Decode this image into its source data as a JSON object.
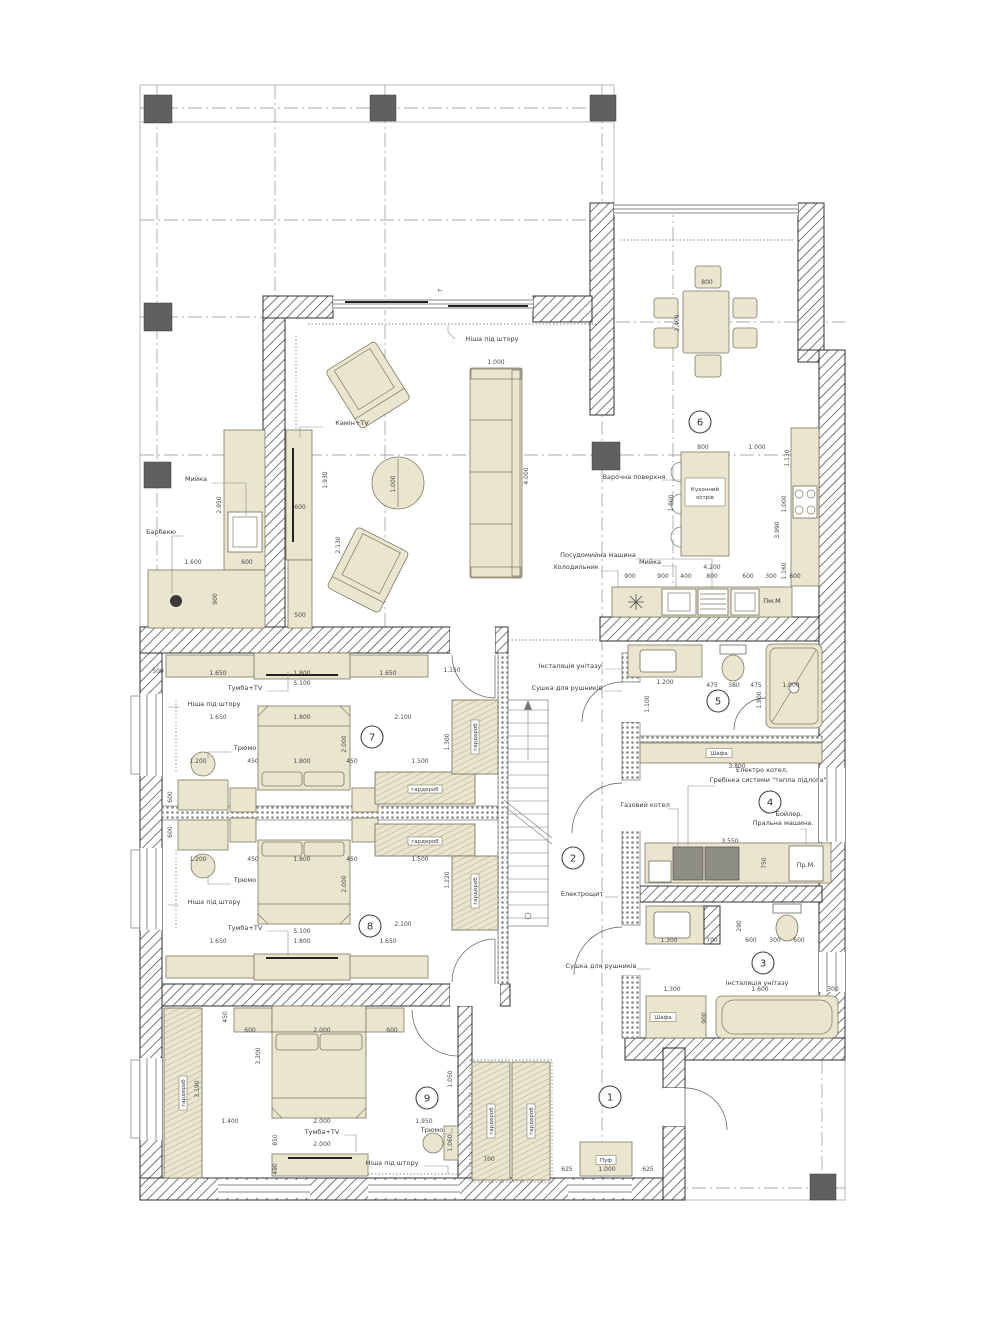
{
  "colors": {
    "furniture_fill": "#eae5ce",
    "wall_line": "#2f2f2f",
    "column_fill": "#606060",
    "dim_text": "#4a4a4a",
    "grid_line": "#8f8f8f"
  },
  "plan": {
    "room_numbers": [
      {
        "n": "1",
        "x": 610,
        "y": 1097
      },
      {
        "n": "2",
        "x": 573,
        "y": 858
      },
      {
        "n": "3",
        "x": 763,
        "y": 963
      },
      {
        "n": "4",
        "x": 770,
        "y": 802
      },
      {
        "n": "5",
        "x": 718,
        "y": 701
      },
      {
        "n": "6",
        "x": 700,
        "y": 422
      },
      {
        "n": "7",
        "x": 372,
        "y": 737
      },
      {
        "n": "8",
        "x": 370,
        "y": 926
      },
      {
        "n": "9",
        "x": 427,
        "y": 1098
      }
    ],
    "furniture_labels": [
      {
        "t": "Ніша під штору",
        "x": 492,
        "y": 341,
        "ld": [
          [
            455,
            339
          ],
          [
            448,
            332
          ],
          [
            448,
            325
          ]
        ]
      },
      {
        "t": "Камін+TV",
        "x": 352,
        "y": 425,
        "ld": [
          [
            323,
            427
          ],
          [
            300,
            427
          ],
          [
            300,
            438
          ]
        ]
      },
      {
        "t": "Мийка",
        "x": 196,
        "y": 481,
        "ld": [
          [
            212,
            483
          ],
          [
            246,
            483
          ],
          [
            246,
            516
          ]
        ]
      },
      {
        "t": "Барбекю",
        "x": 161,
        "y": 534,
        "ld": [
          [
            183,
            536
          ],
          [
            172,
            536
          ],
          [
            172,
            594
          ]
        ]
      },
      {
        "t": "Варочна поверхня",
        "x": 634,
        "y": 479,
        "ld": [
          [
            662,
            480
          ],
          [
            682,
            480
          ]
        ]
      },
      {
        "t": "Посудомийна машина",
        "x": 598,
        "y": 557,
        "ld": [
          [
            636,
            559
          ],
          [
            712,
            559
          ],
          [
            712,
            588
          ]
        ]
      },
      {
        "t": "Мийка",
        "x": 650,
        "y": 564,
        "ld": [
          [
            662,
            566
          ],
          [
            676,
            566
          ],
          [
            676,
            588
          ]
        ]
      },
      {
        "t": "Холодильник",
        "x": 576,
        "y": 569,
        "ld": [
          [
            601,
            571
          ],
          [
            618,
            571
          ],
          [
            618,
            588
          ]
        ]
      },
      {
        "t": "Пм.М",
        "x": 772,
        "y": 603
      },
      {
        "t": "Інсталяція унітазу",
        "x": 570,
        "y": 668,
        "ld": [
          [
            605,
            669
          ],
          [
            622,
            669
          ]
        ]
      },
      {
        "t": "Сушка для рушників",
        "x": 567,
        "y": 690,
        "ld": [
          [
            604,
            691
          ],
          [
            622,
            691
          ]
        ]
      },
      {
        "t": "Електро котел,",
        "x": 762,
        "y": 772
      },
      {
        "t": "Гребінка системи \"тепла підлога\"",
        "x": 768,
        "y": 782,
        "ld": [
          [
            716,
            786
          ],
          [
            688,
            786
          ],
          [
            688,
            846
          ]
        ]
      },
      {
        "t": "Газовий котел",
        "x": 645,
        "y": 807,
        "ld": [
          [
            668,
            809
          ],
          [
            678,
            809
          ],
          [
            678,
            846
          ]
        ]
      },
      {
        "t": "Бойлер,",
        "x": 789,
        "y": 816
      },
      {
        "t": "Пральна машина.",
        "x": 783,
        "y": 825,
        "ld": [
          [
            800,
            829
          ],
          [
            806,
            829
          ],
          [
            806,
            845
          ]
        ]
      },
      {
        "t": "Пр.М.",
        "x": 806,
        "y": 867
      },
      {
        "t": "Сушка для рушників",
        "x": 601,
        "y": 968,
        "ld": [
          [
            637,
            969
          ],
          [
            650,
            969
          ]
        ]
      },
      {
        "t": "Інсталяція унітазу",
        "x": 757,
        "y": 985
      },
      {
        "t": "Тумба+TV",
        "x": 245,
        "y": 690,
        "ld": [
          [
            267,
            691
          ],
          [
            288,
            691
          ],
          [
            288,
            672
          ]
        ]
      },
      {
        "t": "Ніша під штору",
        "x": 214,
        "y": 706,
        "ld": [
          [
            179,
            707
          ],
          [
            168,
            707
          ]
        ]
      },
      {
        "t": "Трюмо",
        "x": 245,
        "y": 750,
        "ld": [
          [
            231,
            752
          ],
          [
            208,
            752
          ],
          [
            208,
            758
          ]
        ]
      },
      {
        "t": "Трюмо",
        "x": 245,
        "y": 882,
        "ld": [
          [
            231,
            884
          ],
          [
            208,
            884
          ],
          [
            208,
            876
          ]
        ]
      },
      {
        "t": "Ніша під штору",
        "x": 214,
        "y": 904,
        "ld": [
          [
            179,
            905
          ],
          [
            168,
            905
          ]
        ]
      },
      {
        "t": "Тумба+TV",
        "x": 245,
        "y": 930,
        "ld": [
          [
            267,
            931
          ],
          [
            288,
            931
          ],
          [
            288,
            956
          ]
        ]
      },
      {
        "t": "Електрощит",
        "x": 582,
        "y": 896,
        "ld": [
          [
            605,
            897
          ],
          [
            618,
            897
          ]
        ]
      },
      {
        "t": "Тумба+TV",
        "x": 322,
        "y": 1134,
        "ld": [
          [
            344,
            1135
          ],
          [
            356,
            1135
          ],
          [
            356,
            1152
          ]
        ]
      },
      {
        "t": "Трюмо",
        "x": 432,
        "y": 1132,
        "ld": [
          [
            445,
            1134
          ],
          [
            452,
            1134
          ],
          [
            452,
            1128
          ]
        ]
      },
      {
        "t": "Ніша під штору",
        "x": 392,
        "y": 1165,
        "ld": [
          [
            424,
            1166
          ],
          [
            448,
            1166
          ],
          [
            448,
            1174
          ]
        ]
      }
    ],
    "boxed_labels": [
      {
        "t": "Кухонний",
        "t2": "острів",
        "x": 705,
        "y": 492,
        "w": 40,
        "h": 18
      },
      {
        "t": "Шафа",
        "x": 719,
        "y": 753,
        "w": 26,
        "h": 9
      },
      {
        "t": "Шафа",
        "x": 663,
        "y": 1017,
        "w": 26,
        "h": 9
      },
      {
        "t": "Пуф",
        "x": 606,
        "y": 1160,
        "w": 20,
        "h": 9
      },
      {
        "t": "гардероб",
        "x": 425,
        "y": 789,
        "w": 34,
        "h": 8
      },
      {
        "t": "гардероб",
        "x": 425,
        "y": 841,
        "w": 34,
        "h": 8
      },
      {
        "t": "гардероб",
        "x": 475,
        "y": 737,
        "w": 34,
        "h": 8,
        "r": 1
      },
      {
        "t": "гардероб",
        "x": 475,
        "y": 891,
        "w": 34,
        "h": 8,
        "r": 1
      },
      {
        "t": "гардероб",
        "x": 183,
        "y": 1093,
        "w": 34,
        "h": 8,
        "r": 1
      },
      {
        "t": "гардероб",
        "x": 491,
        "y": 1121,
        "w": 34,
        "h": 8,
        "r": 1
      },
      {
        "t": "гардероб",
        "x": 531,
        "y": 1121,
        "w": 34,
        "h": 8,
        "r": 1
      }
    ],
    "dimension_labels": [
      {
        "t": "←",
        "x": 440,
        "y": 292
      },
      {
        "t": "1.000",
        "x": 496,
        "y": 364
      },
      {
        "t": "4.000",
        "x": 528,
        "y": 476,
        "r": 1
      },
      {
        "t": "1.000",
        "x": 395,
        "y": 484,
        "r": 1
      },
      {
        "t": "2.130",
        "x": 340,
        "y": 545,
        "r": 1
      },
      {
        "t": "1.930",
        "x": 327,
        "y": 480,
        "r": 1
      },
      {
        "t": "600",
        "x": 300,
        "y": 509
      },
      {
        "t": "500",
        "x": 300,
        "y": 617
      },
      {
        "t": "2.950",
        "x": 221,
        "y": 505,
        "r": 1
      },
      {
        "t": "1.600",
        "x": 193,
        "y": 564
      },
      {
        "t": "600",
        "x": 247,
        "y": 564
      },
      {
        "t": "900",
        "x": 217,
        "y": 599,
        "r": 1
      },
      {
        "t": "800",
        "x": 707,
        "y": 284
      },
      {
        "t": "1.400",
        "x": 679,
        "y": 323,
        "r": 1
      },
      {
        "t": "800",
        "x": 703,
        "y": 449
      },
      {
        "t": "1.000",
        "x": 757,
        "y": 449
      },
      {
        "t": "1.800",
        "x": 673,
        "y": 503,
        "r": 1
      },
      {
        "t": "1.130",
        "x": 789,
        "y": 458,
        "r": 1
      },
      {
        "t": "1.000",
        "x": 786,
        "y": 504,
        "r": 1
      },
      {
        "t": "3.990",
        "x": 779,
        "y": 530,
        "r": 1
      },
      {
        "t": "1.160",
        "x": 786,
        "y": 571,
        "r": 1
      },
      {
        "t": "4.200",
        "x": 712,
        "y": 569
      },
      {
        "t": "900",
        "x": 630,
        "y": 578
      },
      {
        "t": "900",
        "x": 663,
        "y": 578
      },
      {
        "t": "400",
        "x": 686,
        "y": 578
      },
      {
        "t": "800",
        "x": 712,
        "y": 578
      },
      {
        "t": "600",
        "x": 748,
        "y": 578
      },
      {
        "t": "300",
        "x": 771,
        "y": 578
      },
      {
        "t": "600",
        "x": 795,
        "y": 578
      },
      {
        "t": "1.200",
        "x": 665,
        "y": 684
      },
      {
        "t": "475",
        "x": 712,
        "y": 687
      },
      {
        "t": "380",
        "x": 734,
        "y": 687
      },
      {
        "t": "475",
        "x": 756,
        "y": 687
      },
      {
        "t": "1.000",
        "x": 791,
        "y": 687
      },
      {
        "t": "1.100",
        "x": 649,
        "y": 704,
        "r": 1
      },
      {
        "t": "1.900",
        "x": 761,
        "y": 700,
        "r": 1
      },
      {
        "t": "3.800",
        "x": 737,
        "y": 768
      },
      {
        "t": "3.550",
        "x": 730,
        "y": 843
      },
      {
        "t": "750",
        "x": 766,
        "y": 863,
        "r": 1
      },
      {
        "t": "1.300",
        "x": 669,
        "y": 942
      },
      {
        "t": "700",
        "x": 712,
        "y": 942
      },
      {
        "t": "600",
        "x": 751,
        "y": 942
      },
      {
        "t": "300",
        "x": 775,
        "y": 942
      },
      {
        "t": "600",
        "x": 799,
        "y": 942
      },
      {
        "t": "290",
        "x": 741,
        "y": 926,
        "r": 1
      },
      {
        "t": "1.300",
        "x": 672,
        "y": 991
      },
      {
        "t": "1.600",
        "x": 760,
        "y": 991
      },
      {
        "t": "300",
        "x": 833,
        "y": 991
      },
      {
        "t": "900",
        "x": 706,
        "y": 1018,
        "r": 1
      },
      {
        "t": "500",
        "x": 158,
        "y": 673
      },
      {
        "t": "1.650",
        "x": 218,
        "y": 675
      },
      {
        "t": "1.800",
        "x": 302,
        "y": 675
      },
      {
        "t": "1.650",
        "x": 388,
        "y": 675
      },
      {
        "t": "1.150",
        "x": 452,
        "y": 672
      },
      {
        "t": "5.100",
        "x": 302,
        "y": 685
      },
      {
        "t": "1.650",
        "x": 218,
        "y": 719
      },
      {
        "t": "1.800",
        "x": 302,
        "y": 719
      },
      {
        "t": "2.100",
        "x": 403,
        "y": 719
      },
      {
        "t": "1.200",
        "x": 198,
        "y": 763
      },
      {
        "t": "450",
        "x": 253,
        "y": 763
      },
      {
        "t": "1.800",
        "x": 302,
        "y": 763
      },
      {
        "t": "450",
        "x": 352,
        "y": 763
      },
      {
        "t": "1.500",
        "x": 420,
        "y": 763
      },
      {
        "t": "2.000",
        "x": 346,
        "y": 744,
        "r": 1
      },
      {
        "t": "1.300",
        "x": 449,
        "y": 742,
        "r": 1
      },
      {
        "t": "600",
        "x": 172,
        "y": 797,
        "r": 1
      },
      {
        "t": "1.200",
        "x": 198,
        "y": 861
      },
      {
        "t": "450",
        "x": 253,
        "y": 861
      },
      {
        "t": "1.800",
        "x": 302,
        "y": 861
      },
      {
        "t": "450",
        "x": 352,
        "y": 861
      },
      {
        "t": "1.500",
        "x": 420,
        "y": 861
      },
      {
        "t": "2.000",
        "x": 346,
        "y": 884,
        "r": 1
      },
      {
        "t": "1.220",
        "x": 449,
        "y": 880,
        "r": 1
      },
      {
        "t": "600",
        "x": 172,
        "y": 832,
        "r": 1
      },
      {
        "t": "1.650",
        "x": 218,
        "y": 943
      },
      {
        "t": "1.800",
        "x": 302,
        "y": 943
      },
      {
        "t": "1.650",
        "x": 388,
        "y": 943
      },
      {
        "t": "5.100",
        "x": 302,
        "y": 933
      },
      {
        "t": "2.100",
        "x": 403,
        "y": 926
      },
      {
        "t": "450",
        "x": 227,
        "y": 1017,
        "r": 1
      },
      {
        "t": "600",
        "x": 250,
        "y": 1032
      },
      {
        "t": "2.000",
        "x": 322,
        "y": 1032
      },
      {
        "t": "600",
        "x": 392,
        "y": 1032
      },
      {
        "t": "3.200",
        "x": 260,
        "y": 1056,
        "r": 1
      },
      {
        "t": "1.400",
        "x": 230,
        "y": 1123
      },
      {
        "t": "2.000",
        "x": 322,
        "y": 1123
      },
      {
        "t": "1.950",
        "x": 424,
        "y": 1123
      },
      {
        "t": "850",
        "x": 277,
        "y": 1140,
        "r": 1
      },
      {
        "t": "2.000",
        "x": 322,
        "y": 1146
      },
      {
        "t": "490",
        "x": 277,
        "y": 1169,
        "r": 1
      },
      {
        "t": "3.190",
        "x": 199,
        "y": 1089,
        "r": 1
      },
      {
        "t": "1.050",
        "x": 452,
        "y": 1079,
        "r": 1
      },
      {
        "t": "1.060",
        "x": 452,
        "y": 1143,
        "r": 1
      },
      {
        "t": "700",
        "x": 489,
        "y": 1161
      },
      {
        "t": "625",
        "x": 567,
        "y": 1171
      },
      {
        "t": "1.000",
        "x": 607,
        "y": 1171
      },
      {
        "t": "625",
        "x": 648,
        "y": 1171
      }
    ]
  }
}
